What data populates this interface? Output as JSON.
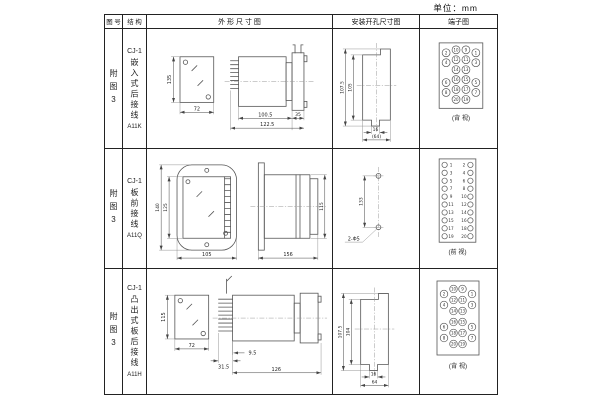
{
  "unit_label": "单位：mm",
  "headers": {
    "fig": "图 号",
    "structure": "结 构",
    "outline": "外 形 尺 寸 图",
    "mounting": "安装开孔尺寸图",
    "terminal": "端子图"
  },
  "rows": [
    {
      "fig": "附图3",
      "model": "CJ-1",
      "mount_type": "嵌入式后接线",
      "code": "A11K",
      "outline": {
        "front_h": "135",
        "front_w": "72",
        "body_l": "100.5",
        "total_l": "122.5",
        "flange_w": "35"
      },
      "mounting": {
        "outer_h": "107.5",
        "inner_h": "105",
        "slot_w": "16",
        "total_w": "(64)"
      },
      "terminal": {
        "layout": "grid",
        "view_label": "(背 视)",
        "rows": [
          [
            "2",
            "10",
            "9",
            "1"
          ],
          [
            "4",
            "12",
            "11",
            "3"
          ],
          [
            "",
            "14",
            "13",
            ""
          ],
          [
            "6",
            "16",
            "15",
            "5"
          ],
          [
            "8",
            "18",
            "17",
            "7"
          ],
          [
            "",
            "20",
            "19",
            ""
          ]
        ]
      }
    },
    {
      "fig": "附图3",
      "model": "CJ-1",
      "mount_type": "板前接线",
      "code": "A11Q",
      "outline": {
        "front_outer_h": "140",
        "front_inner_h": "125",
        "front_w": "105",
        "side_l": "156",
        "side_h": "115"
      },
      "mounting": {
        "hole_dist": "133",
        "hole_spec": "2-Φ5"
      },
      "terminal": {
        "layout": "strip",
        "view_label": "(前 视)",
        "left": [
          "1",
          "3",
          "5",
          "7",
          "9",
          "11",
          "13",
          "15",
          "17",
          "19"
        ],
        "right": [
          "2",
          "4",
          "6",
          "8",
          "10",
          "12",
          "14",
          "16",
          "18",
          "20"
        ]
      }
    },
    {
      "fig": "附图3",
      "model": "CJ-1",
      "mount_type": "凸出式板后接线",
      "code": "A11H",
      "outline": {
        "front_h": "115",
        "front_w": "72",
        "pin_l": "31.5",
        "pin_off": "9.5",
        "total_l": "126"
      },
      "mounting": {
        "outer_h": "107.5",
        "inner_h": "104",
        "slot_w": "16",
        "total_w": "64"
      },
      "terminal": {
        "layout": "grid-staggered",
        "view_label": "(背 视)",
        "rows": [
          [
            "2",
            "10",
            "9",
            "1"
          ],
          [
            "4",
            "12",
            "11",
            "3"
          ],
          [
            "",
            "14",
            "13",
            ""
          ],
          [
            "6",
            "16",
            "15",
            "5"
          ],
          [
            "8",
            "18",
            "17",
            "7"
          ],
          [
            "",
            "20",
            "19",
            ""
          ]
        ]
      }
    }
  ]
}
